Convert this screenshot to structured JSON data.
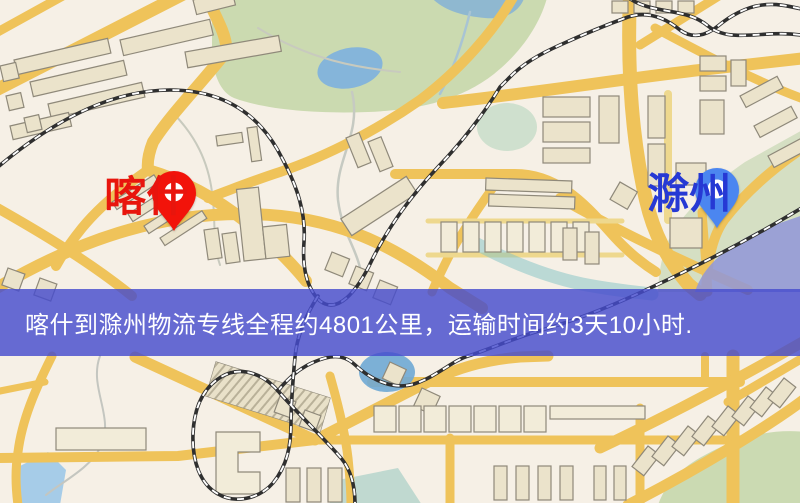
{
  "banner": {
    "text": "喀什到滁州物流专线全程约4801公里，运输时间约3天10小时.",
    "background_rgba": "rgba(70,76,205,0.82)",
    "text_color": "#ffffff"
  },
  "map": {
    "type": "road-map",
    "background_color": "#f6f0e6",
    "road_color": "#efc35a",
    "minor_road_color": "#eed88e",
    "park_color": "#cbdab0",
    "water_color": "#85b5da",
    "railway_color": "#2f2f2f",
    "building_color": "#ebe3cb",
    "markers": [
      {
        "id": "origin",
        "label": "喀什",
        "pin_color": "#f2130a",
        "label_color": "#e8150d",
        "x": 148,
        "y": 170
      },
      {
        "id": "destination",
        "label": "滁州",
        "pin_color": "#4b86f0",
        "label_color": "#2639d4",
        "x": 691,
        "y": 167
      }
    ]
  }
}
